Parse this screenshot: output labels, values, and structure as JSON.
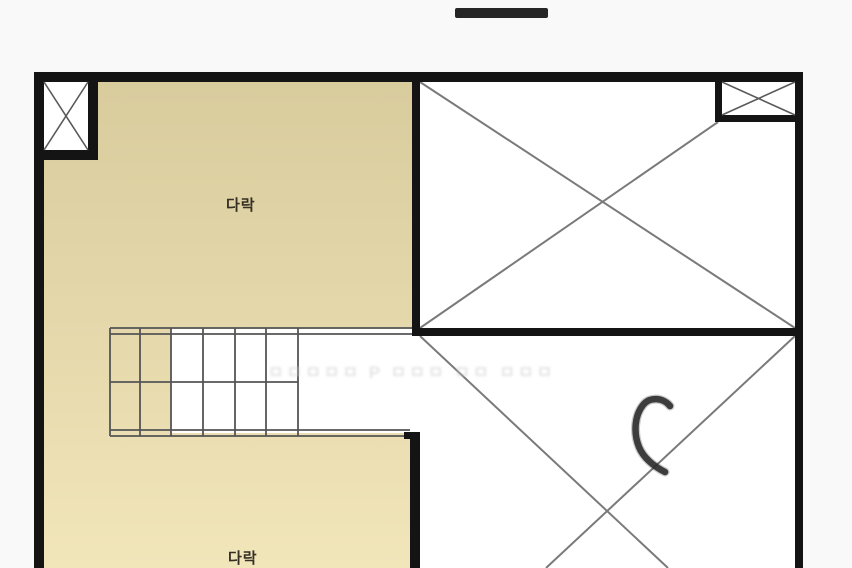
{
  "page": {
    "background": "#f9f9f9"
  },
  "top_bar": {
    "shape": "dark-horizontal-handle",
    "color": "#262626"
  },
  "labels": {
    "attic_upper": "다락",
    "attic_lower": "다락"
  },
  "watermark": {
    "text": "ㅁㅁㅁㅁㅁ P ㅁㅁㅁ ㅁㅁ ㅁㅁㅁ"
  },
  "colors": {
    "attic_fill_top": "#d8cb9c",
    "attic_fill_bottom": "#f1e5ba",
    "wall": "#141414",
    "stair_line": "#555555",
    "diagonal_line": "#7a7a7a",
    "cross_line": "#5a5a5a",
    "pen_mark": "#2d2d2d",
    "room_white": "#ffffff",
    "label_text": "#352f24",
    "watermark_gray": "#cfcfcf"
  }
}
